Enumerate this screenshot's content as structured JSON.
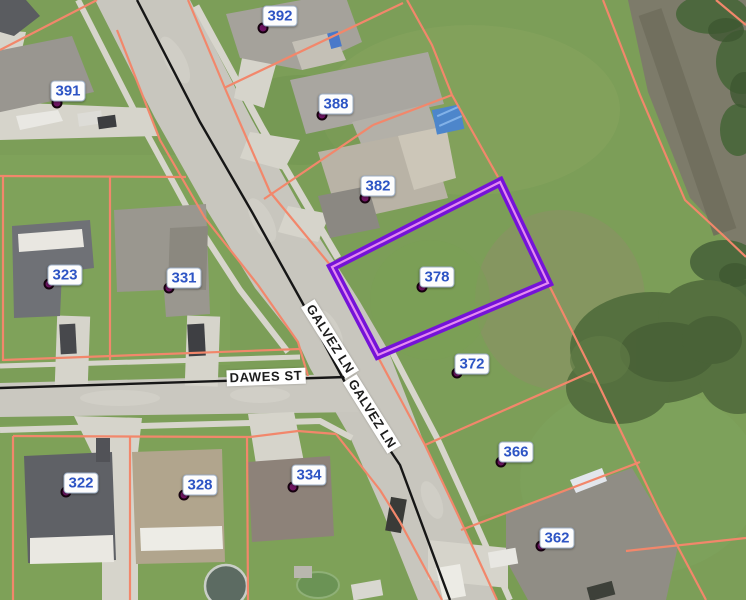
{
  "map": {
    "parcels": [
      {
        "number": "392"
      },
      {
        "number": "391"
      },
      {
        "number": "388"
      },
      {
        "number": "382"
      },
      {
        "number": "378"
      },
      {
        "number": "372"
      },
      {
        "number": "366"
      },
      {
        "number": "362"
      },
      {
        "number": "323"
      },
      {
        "number": "331"
      },
      {
        "number": "322"
      },
      {
        "number": "328"
      },
      {
        "number": "334"
      }
    ],
    "selected_parcel": "378",
    "streets": {
      "dawes": "DAWES ST",
      "galvez": "GALVEZ LN"
    },
    "colors": {
      "parcel_line": "#f2876b",
      "highlight_outline": "#7512d8",
      "highlight_inner": "#e48af2",
      "parcel_label_text": "#2d54c4",
      "parcel_dot": "#6e1563",
      "road": "#c8c6be",
      "water": "#7d7b6a",
      "grass": "#7c9e58",
      "centerline": "#161616"
    }
  }
}
